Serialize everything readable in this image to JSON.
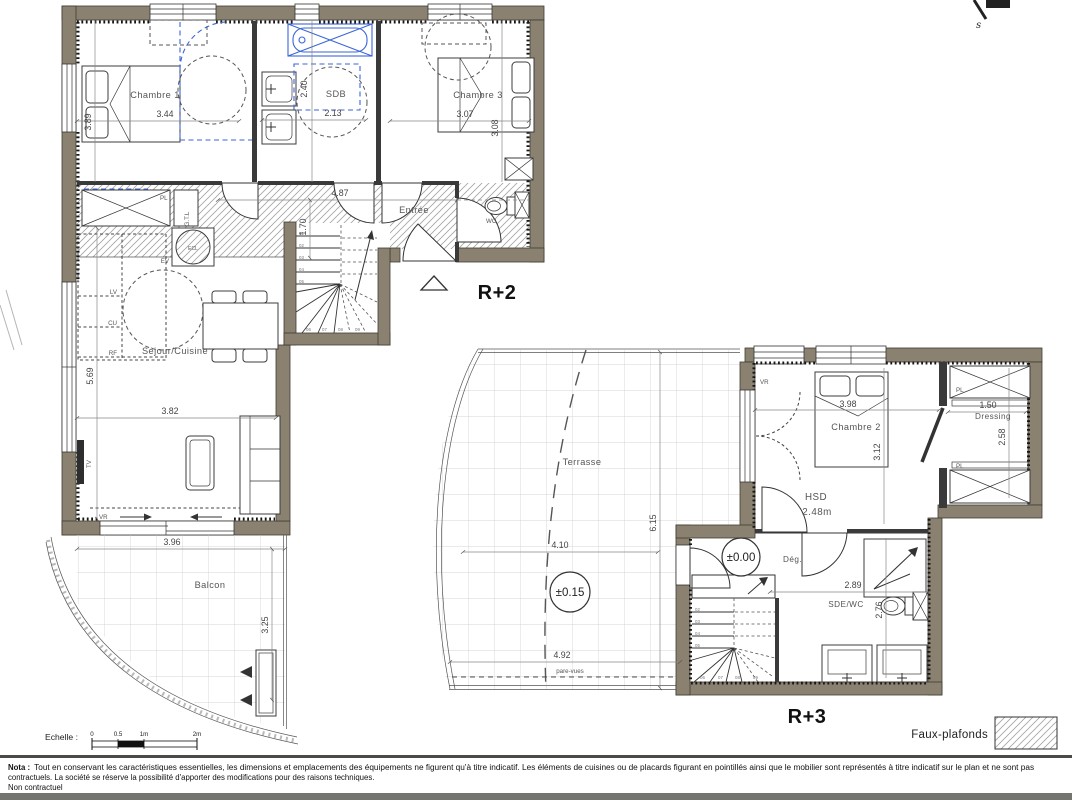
{
  "logo": {
    "letter": "s"
  },
  "r2": {
    "label": "R+2",
    "chambre1": {
      "name": "Chambre 1",
      "width": "3.44",
      "height": "3.89"
    },
    "sdb": {
      "name": "SDB",
      "width": "2.13",
      "height": "2.40"
    },
    "chambre3": {
      "name": "Chambre 3",
      "width": "3.07",
      "height": "3.08"
    },
    "entree": {
      "name": "Entrée",
      "width": "4.87",
      "height": "1.70"
    },
    "wc": {
      "name": "WC"
    },
    "sejour": {
      "name": "Séjour/Cuisine",
      "width": "3.82",
      "depth": "5.69"
    },
    "balcon": {
      "name": "Balcon",
      "width": "3.96",
      "depth": "3.25"
    },
    "tags": {
      "pl": "PL",
      "gtl": "G.T.L",
      "ecl": "ECL",
      "ev": "EV",
      "lv": "LV",
      "cu": "CU",
      "rf": "RF",
      "tv": "TV",
      "vr": "VR"
    },
    "steps": [
      "01",
      "02",
      "03",
      "04",
      "05",
      "06",
      "07",
      "08",
      "09"
    ]
  },
  "r3": {
    "label": "R+3",
    "terrasse": {
      "name": "Terrasse",
      "width": "4.10",
      "width2": "4.92",
      "depth": "6.15",
      "level": "±0.15",
      "screen": "pare-vues"
    },
    "chambre2": {
      "name": "Chambre 2",
      "width": "3.98",
      "height": "3.12"
    },
    "dressing": {
      "name": "Dressing",
      "width": "1.50",
      "height": "2.58"
    },
    "degagement": {
      "name": "Dég.",
      "level": "±0.00"
    },
    "hsd": {
      "label": "HSD",
      "value": "2.48m"
    },
    "sdewc": {
      "name": "SDE/WC",
      "width": "2.89",
      "height": "2.76"
    },
    "tags": {
      "pl": "PL",
      "vr": "VR"
    },
    "steps": [
      "02",
      "03",
      "04",
      "05",
      "06",
      "07",
      "08",
      "09"
    ]
  },
  "legend": {
    "faux_plafonds": "Faux-plafonds"
  },
  "scale": {
    "label": "Echelle :",
    "t0": "0",
    "t05": "0.5",
    "t1": "1m",
    "t2": "2m"
  },
  "nota": {
    "title": "Nota :",
    "line1": "Tout en conservant les caractéristiques essentielles, les dimensions et emplacements des équipements ne figurent qu'à titre indicatif. Les éléments de cuisines ou de placards figurant en pointillés ainsi que le mobilier sont représentés à titre indicatif sur le plan et ne sont pas",
    "line2": "contractuels. La société se réserve la possibilité d'apporter des modifications pour des raisons techniques.",
    "line3": "Non contractuel"
  }
}
